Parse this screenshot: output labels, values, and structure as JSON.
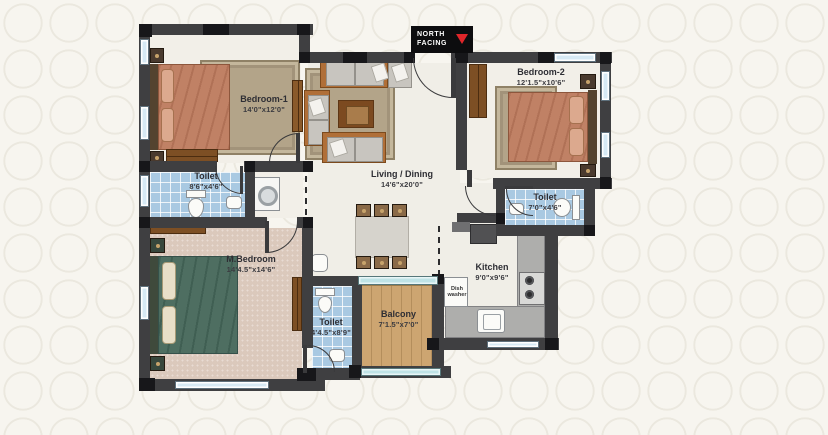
{
  "north_badge": {
    "line1": "NORTH",
    "line2": "FACING"
  },
  "rooms": {
    "bedroom1": {
      "name": "Bedroom-1",
      "dims": "14'0\"x12'0\""
    },
    "toilet1": {
      "name": "Toilet",
      "dims": "8'6\"x4'6\""
    },
    "master_bedroom": {
      "name": "M.Bedroom",
      "dims": "14'4.5\"x14'6\""
    },
    "master_toilet": {
      "name": "Toilet",
      "dims": "4'4.5\"x8'9\""
    },
    "balcony": {
      "name": "Balcony",
      "dims": "7'1.5\"x7'0\""
    },
    "kitchen": {
      "name": "Kitchen",
      "dims": "9'0\"x9'6\""
    },
    "toilet2": {
      "name": "Toilet",
      "dims": "7'0\"x4'6\""
    },
    "bedroom2": {
      "name": "Bedroom-2",
      "dims": "12'1.5\"x10'6\""
    },
    "living_dining": {
      "name": "Living / Dining",
      "dims": "14'6\"x20'0\""
    }
  },
  "appliances": {
    "dish_washer": "Dish washer"
  },
  "colors": {
    "wall": "#3f3f41",
    "tile_blue": "#a9c9e2",
    "balcony_wood": "#cda571",
    "bed1_salmon": "#c08165",
    "master_bed_teal": "#4e6e61",
    "north_arrow_red": "#e0262a"
  }
}
